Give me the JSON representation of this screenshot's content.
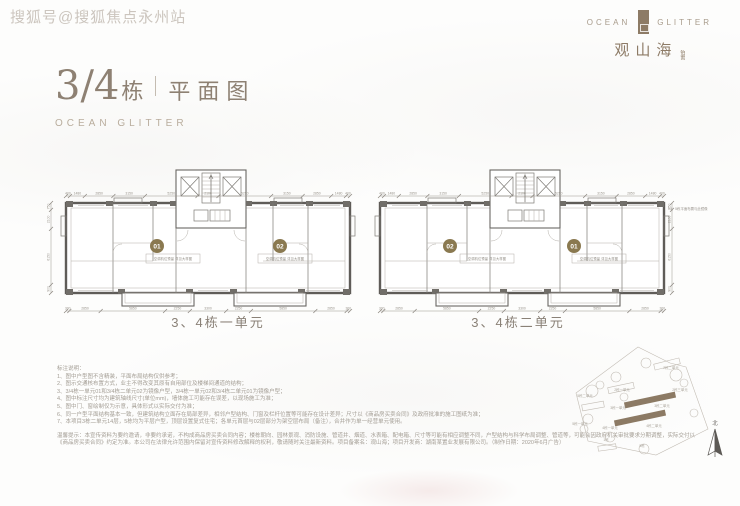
{
  "watermark": "搜狐号@搜狐焦点永州站",
  "logo": {
    "left": "OCEAN",
    "right": "GLITTER",
    "cn": "观山海",
    "suffix": "铂寓"
  },
  "header": {
    "number": "3/4",
    "dong": "栋",
    "rest": "平面图",
    "subtitle": "OCEAN GLITTER"
  },
  "accent_colors": {
    "brand_taupe": "#8d7b66",
    "badge_olive": "#8a7950",
    "line_gray": "#5f5c58"
  },
  "floorplans": [
    {
      "caption": "3、4栋一单元",
      "badges": [
        {
          "no": "01"
        },
        {
          "no": "02"
        }
      ],
      "unit_note": "空调机位预留 详见大样图",
      "dims_top": [
        "400",
        "1480",
        "2850",
        "3150",
        "5250",
        "2100",
        "5250",
        "3150",
        "2850",
        "1480",
        "400"
      ],
      "dims_bottom": [
        "300",
        "2850",
        "5850",
        "2250",
        "3300",
        "2250",
        "5850",
        "2850",
        "300"
      ],
      "dims_side": [
        "750",
        "2100",
        "6150",
        "900"
      ]
    },
    {
      "caption": "3、4栋二单元",
      "badges": [
        {
          "no": "02"
        },
        {
          "no": "01"
        }
      ],
      "unit_note": "空调机位预留 详见大样图",
      "dims_top": [
        "400",
        "1480",
        "2850",
        "3150",
        "5250",
        "2100",
        "5250",
        "3150",
        "2850",
        "1480",
        "400"
      ],
      "dims_bottom": [
        "300",
        "2850",
        "5850",
        "2250",
        "3300",
        "2250",
        "5850",
        "2850",
        "300"
      ],
      "dims_side": [
        "750",
        "2100",
        "6150",
        "900"
      ]
    }
  ],
  "side_annotation": "03、5栋平面布置与此镜像",
  "notes": {
    "title": "标注说明：",
    "items": [
      "1、图中户型图不含精装，平面布局结构仅供参考；",
      "2、图示交通核布置方式，业主不得改变其原有自用部位及楼梯间通道的结构；",
      "3、3/4栋一单元01和3/4栋二单元02为镜像户型，3/4栋一单元02和3/4栋二单元01为镜像户型；",
      "4、图中标注尺寸均为建筑轴线尺寸(单位mm)，墙体施工可能存在误差，以现场施工为准；",
      "5、图中门、窗绘制仅为示意，具体形式以实际交付为准；",
      "6、同一户型平面结构基本一致，但建筑结构立面存在局部差异，相邻户型结构、门窗及栏杆位置等可能存在设计差异；尺寸以《商品房买卖合同》及政府批准的施工图纸为准；",
      "7、本项目3栋二单元14层，5栋均为平层户型，顶层设置复式住宅；各单元首层与02层部分为架空层布局（备注），合并作为单一经营单元使用。"
    ],
    "tips": "温馨提示：本宣传资料为要约邀请，非要约承诺，不构成商品房买卖合同内容；楼栋朝向、园林景观、消防设施、管道井、烟道、水表箱、配电箱、尺寸等可能有相应调整不同，户型结构与科学布局调整、管道等，可能会因政府机关审批要求分期调整，实际交付以《商品房买卖合同》约定为准。本公司在法律允许范围内保留对宣传资料修改解释的权利，敬请随时关注最新资料。项目备案名：观山海；项目开发商：湖南某置业发展有限公司。（制作日期：2020年6月广告）"
  },
  "siteplan": {
    "north": "北",
    "labels": [
      {
        "t": "2栋二单元",
        "x": 113,
        "y": 36
      },
      {
        "t": "2栋一单元",
        "x": 64,
        "y": 58
      },
      {
        "t": "2栋三单元",
        "x": 122,
        "y": 58
      },
      {
        "t": "5栋二单元",
        "x": 27,
        "y": 64
      },
      {
        "t": "5栋一单元",
        "x": 22,
        "y": 92
      },
      {
        "t": "3栋一单元",
        "x": 60,
        "y": 76
      },
      {
        "t": "3栋二单元",
        "x": 104,
        "y": 74
      },
      {
        "t": "4栋一单元",
        "x": 52,
        "y": 96
      },
      {
        "t": "4栋二单元",
        "x": 96,
        "y": 94
      },
      {
        "t": "1栋",
        "x": 48,
        "y": 108
      },
      {
        "t": "5栋",
        "x": 84,
        "y": 114
      }
    ]
  }
}
